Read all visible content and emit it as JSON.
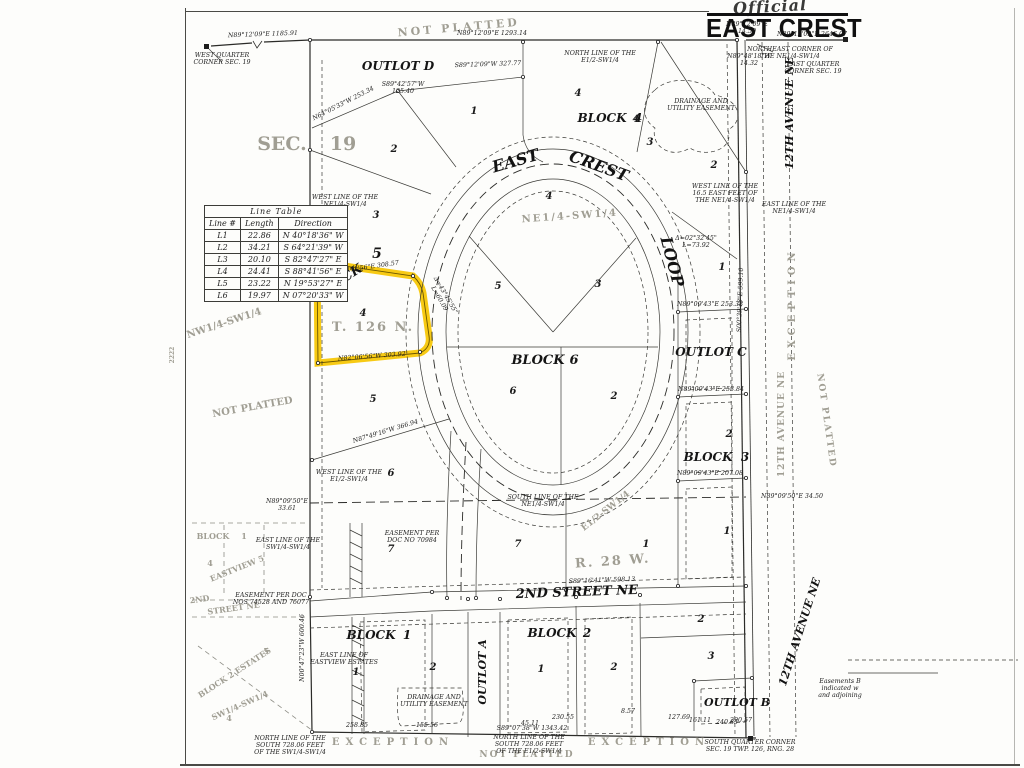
{
  "title": {
    "handwritten": "Official",
    "main": "EAST CREST"
  },
  "colors": {
    "highlight": "#f6c500",
    "ink": "#2b2b28",
    "watermark": "#a09e93",
    "paper": "#fdfdfb"
  },
  "line_table": {
    "title": "Line Table",
    "headers": [
      "Line #",
      "Length",
      "Direction"
    ],
    "rows": [
      [
        "L1",
        "22.86",
        "N 40°18'36\" W"
      ],
      [
        "L2",
        "34.21",
        "S 64°21'39\" W"
      ],
      [
        "L3",
        "20.10",
        "S 82°47'27\" E"
      ],
      [
        "L4",
        "24.41",
        "S 88°41'56\" E"
      ],
      [
        "L5",
        "23.22",
        "N 19°53'27\" E"
      ],
      [
        "L6",
        "19.97",
        "N 07°20'33\" W"
      ]
    ]
  },
  "map": {
    "labels": [
      {
        "n": "street-east",
        "c": "street",
        "t": "EAST",
        "x": 517,
        "y": 166,
        "s": 16,
        "r": -16
      },
      {
        "n": "street-crest",
        "c": "street",
        "t": "CREST",
        "x": 597,
        "y": 171,
        "s": 16,
        "r": 20
      },
      {
        "n": "street-loop",
        "c": "street",
        "t": "LOOP",
        "x": 667,
        "y": 263,
        "s": 16,
        "r": 75
      },
      {
        "n": "street-2nd-street-ne",
        "c": "street",
        "t": "2ND STREET NE",
        "x": 577,
        "y": 596,
        "s": 13,
        "r": -2
      },
      {
        "n": "street-12th-avenue-ne-top",
        "c": "street",
        "t": "12TH AVENUE NE",
        "x": 793,
        "y": 113,
        "s": 11,
        "r": -90
      },
      {
        "n": "street-12th-avenue-ne-bottom",
        "c": "street",
        "t": "12TH AVENUE NE",
        "x": 803,
        "y": 633,
        "s": 11,
        "r": -72
      },
      {
        "n": "outlot-d-label",
        "c": "block",
        "t": "OUTLOT D",
        "x": 398,
        "y": 70
      },
      {
        "n": "block-4-label",
        "c": "block",
        "t": "BLOCK",
        "x": 602,
        "y": 122
      },
      {
        "n": "block-4-number",
        "c": "block",
        "t": "4",
        "x": 638,
        "y": 122
      },
      {
        "n": "block-5-label",
        "c": "block",
        "t": "BLOCK",
        "x": 341,
        "y": 285,
        "r": -33,
        "s": 13
      },
      {
        "n": "block-5-number",
        "c": "block",
        "t": "5",
        "x": 377,
        "y": 258,
        "s": 14
      },
      {
        "n": "block-6-label",
        "c": "block",
        "t": "BLOCK",
        "x": 538,
        "y": 364,
        "s": 13
      },
      {
        "n": "block-6-number",
        "c": "block",
        "t": "6",
        "x": 574,
        "y": 364,
        "s": 13
      },
      {
        "n": "outlot-c-label",
        "c": "block",
        "t": "OUTLOT C",
        "x": 711,
        "y": 356
      },
      {
        "n": "block-3-label",
        "c": "block",
        "t": "BLOCK",
        "x": 708,
        "y": 461
      },
      {
        "n": "block-3-number",
        "c": "block",
        "t": "3",
        "x": 745,
        "y": 461
      },
      {
        "n": "block-1-label",
        "c": "block",
        "t": "BLOCK",
        "x": 371,
        "y": 639
      },
      {
        "n": "block-1-number",
        "c": "block",
        "t": "1",
        "x": 407,
        "y": 639
      },
      {
        "n": "block-2-label",
        "c": "block",
        "t": "BLOCK",
        "x": 552,
        "y": 637
      },
      {
        "n": "block-2-number",
        "c": "block",
        "t": "2",
        "x": 587,
        "y": 637
      },
      {
        "n": "outlot-a-label",
        "c": "block",
        "t": "OUTLOT A",
        "x": 486,
        "y": 672,
        "s": 11,
        "r": -90
      },
      {
        "n": "outlot-b-label",
        "c": "block",
        "t": "OUTLOT B",
        "x": 737,
        "y": 706,
        "s": 11
      },
      {
        "n": "lot-number",
        "c": "lot",
        "t": "2",
        "x": 394,
        "y": 152
      },
      {
        "n": "lot-number",
        "c": "lot",
        "t": "3",
        "x": 376,
        "y": 218
      },
      {
        "n": "lot-number",
        "c": "lot",
        "t": "4",
        "x": 363,
        "y": 316
      },
      {
        "n": "lot-number",
        "c": "lot",
        "t": "5",
        "x": 373,
        "y": 402
      },
      {
        "n": "lot-number",
        "c": "lot",
        "t": "6",
        "x": 391,
        "y": 476
      },
      {
        "n": "lot-number",
        "c": "lot",
        "t": "7",
        "x": 391,
        "y": 552
      },
      {
        "n": "lot-number",
        "c": "lot",
        "t": "1",
        "x": 474,
        "y": 114
      },
      {
        "n": "lot-number",
        "c": "lot",
        "t": "4",
        "x": 578,
        "y": 96
      },
      {
        "n": "lot-number",
        "c": "lot",
        "t": "4",
        "x": 636,
        "y": 122
      },
      {
        "n": "lot-number",
        "c": "lot",
        "t": "3",
        "x": 650,
        "y": 145
      },
      {
        "n": "lot-number",
        "c": "lot",
        "t": "2",
        "x": 714,
        "y": 168
      },
      {
        "n": "lot-number",
        "c": "lot",
        "t": "1",
        "x": 722,
        "y": 270
      },
      {
        "n": "lot-number",
        "c": "lot",
        "t": "2",
        "x": 729,
        "y": 437
      },
      {
        "n": "lot-number",
        "c": "lot",
        "t": "1",
        "x": 727,
        "y": 534
      },
      {
        "n": "lot-number",
        "c": "lot",
        "t": "4",
        "x": 549,
        "y": 199
      },
      {
        "n": "lot-number",
        "c": "lot",
        "t": "5",
        "x": 498,
        "y": 289
      },
      {
        "n": "lot-number",
        "c": "lot",
        "t": "3",
        "x": 598,
        "y": 287
      },
      {
        "n": "lot-number",
        "c": "lot",
        "t": "6",
        "x": 513,
        "y": 394
      },
      {
        "n": "lot-number",
        "c": "lot",
        "t": "2",
        "x": 614,
        "y": 399
      },
      {
        "n": "lot-number",
        "c": "lot",
        "t": "7",
        "x": 518,
        "y": 547
      },
      {
        "n": "lot-number",
        "c": "lot",
        "t": "1",
        "x": 646,
        "y": 547
      },
      {
        "n": "lot-number",
        "c": "lot",
        "t": "1",
        "x": 356,
        "y": 675
      },
      {
        "n": "lot-number",
        "c": "lot",
        "t": "2",
        "x": 433,
        "y": 670
      },
      {
        "n": "lot-number",
        "c": "lot",
        "t": "1",
        "x": 541,
        "y": 672
      },
      {
        "n": "lot-number",
        "c": "lot",
        "t": "2",
        "x": 614,
        "y": 670
      },
      {
        "n": "lot-number",
        "c": "lot",
        "t": "2",
        "x": 701,
        "y": 622
      },
      {
        "n": "lot-number",
        "c": "lot",
        "t": "3",
        "x": 711,
        "y": 659
      },
      {
        "n": "wm-not-platted-top",
        "c": "wm",
        "t": "NOT  PLATTED",
        "x": 459,
        "y": 31,
        "s": 11,
        "r": -5,
        "sp": 3
      },
      {
        "n": "wm-sec",
        "c": "wm",
        "t": "SEC.",
        "x": 282,
        "y": 150,
        "s": 19
      },
      {
        "n": "wm-19",
        "c": "wm",
        "t": "19",
        "x": 343,
        "y": 150,
        "s": 19
      },
      {
        "n": "wm-nw14-sw14",
        "c": "wm",
        "t": "NW1/4-SW1/4",
        "x": 225,
        "y": 326,
        "s": 10,
        "r": -18
      },
      {
        "n": "wm-not-platted-left",
        "c": "wm",
        "t": "NOT  PLATTED",
        "x": 253,
        "y": 410,
        "s": 10,
        "r": -10
      },
      {
        "n": "wm-ne14-sw14",
        "c": "wm",
        "t": "NE1/4-SW1/4",
        "x": 570,
        "y": 219,
        "s": 10,
        "r": -4,
        "sp": 2
      },
      {
        "n": "wm-t126n",
        "c": "wm",
        "t": "T. 126 N.",
        "x": 373,
        "y": 331,
        "s": 13,
        "sp": 2
      },
      {
        "n": "wm-r28w",
        "c": "wm",
        "t": "R. 28 W.",
        "x": 613,
        "y": 565,
        "s": 13,
        "r": -4,
        "sp": 2
      },
      {
        "n": "wm-e12-sw14",
        "c": "wm",
        "t": "E1/2-SW1/4",
        "x": 607,
        "y": 513,
        "s": 9,
        "r": -38
      },
      {
        "n": "wm-exception-right",
        "c": "wm",
        "t": "EXCEPTION",
        "x": 795,
        "y": 304,
        "s": 10,
        "r": -90,
        "sp": 5
      },
      {
        "n": "wm-12th-avenue-ne-gray",
        "c": "wm",
        "t": "12TH AVENUE NE",
        "x": 784,
        "y": 424,
        "s": 9,
        "r": -90,
        "sp": 1
      },
      {
        "n": "wm-not-platted-right",
        "c": "wm",
        "t": "NOT  PLATTED",
        "x": 824,
        "y": 421,
        "s": 9,
        "r": 82,
        "sp": 2
      },
      {
        "n": "wm-exception-bottom-left",
        "c": "wm",
        "t": "EXCEPTION",
        "x": 393,
        "y": 745,
        "s": 10,
        "sp": 6
      },
      {
        "n": "wm-exception-bottom-right",
        "c": "wm",
        "t": "EXCEPTION",
        "x": 649,
        "y": 745,
        "s": 10,
        "sp": 6
      },
      {
        "n": "wm-not-platted-bottom",
        "c": "wm",
        "t": "NOT  PLATTED",
        "x": 527,
        "y": 757,
        "s": 9,
        "sp": 2
      },
      {
        "n": "wm-block-1",
        "c": "wm",
        "t": "BLOCK",
        "x": 213,
        "y": 539,
        "s": 8
      },
      {
        "n": "wm-block-1-number",
        "c": "wm",
        "t": "1",
        "x": 244,
        "y": 539,
        "s": 8
      },
      {
        "n": "wm-eastview-4",
        "c": "wm",
        "t": "4",
        "x": 210,
        "y": 566,
        "s": 8
      },
      {
        "n": "wm-eastview",
        "c": "wm",
        "t": "EASTVIEW  5",
        "x": 238,
        "y": 571,
        "s": 8,
        "r": -22
      },
      {
        "n": "wm-2nd",
        "c": "wm",
        "t": "2ND",
        "x": 200,
        "y": 602,
        "s": 8,
        "r": -8
      },
      {
        "n": "wm-street-ne",
        "c": "wm",
        "t": "STREET  NE",
        "x": 234,
        "y": 611,
        "s": 8,
        "r": -8
      },
      {
        "n": "wm-block-2-estates",
        "c": "wm",
        "t": "BLOCK 2 ESTATES",
        "x": 236,
        "y": 675,
        "s": 8,
        "r": -33
      },
      {
        "n": "wm-estates-5",
        "c": "wm",
        "t": "5",
        "x": 266,
        "y": 654,
        "s": 8
      },
      {
        "n": "wm-sw14-sw14",
        "c": "wm",
        "t": "SW1/4-SW1/4",
        "x": 241,
        "y": 708,
        "s": 8,
        "r": -24
      },
      {
        "n": "wm-sw14-4",
        "c": "wm",
        "t": "4",
        "x": 229,
        "y": 721,
        "s": 8
      },
      {
        "n": "wm-2222",
        "c": "wm",
        "t": "2222",
        "x": 174,
        "y": 355,
        "s": 6,
        "r": -90
      },
      {
        "n": "note-west-quarter-corner",
        "c": "note",
        "t": "WEST QUARTER\nCORNER SEC. 19",
        "x": 222,
        "y": 57
      },
      {
        "n": "note-north-line",
        "c": "note",
        "t": "NORTH LINE OF THE\nE1/2-SW1/4",
        "x": 600,
        "y": 55
      },
      {
        "n": "note-northeast-corner",
        "c": "note",
        "t": "NORTHEAST CORNER OF\nTHE NE1/4-SW1/4",
        "x": 790,
        "y": 51
      },
      {
        "n": "note-east-quarter-corner",
        "c": "note",
        "t": "EAST QUARTER\nCORNER SEC. 19",
        "x": 813,
        "y": 66
      },
      {
        "n": "note-west-line-165",
        "c": "note",
        "t": "WEST LINE OF THE\n16.5 EAST FEET OF\nTHE NE1/4-SW1/4",
        "x": 725,
        "y": 188
      },
      {
        "n": "note-east-line-ne14",
        "c": "note",
        "t": "EAST LINE OF THE\nNE1/4-SW1/4",
        "x": 794,
        "y": 206
      },
      {
        "n": "note-west-line-ne14",
        "c": "note",
        "t": "WEST LINE OF THE\nNE1/4-SW1/4",
        "x": 345,
        "y": 199
      },
      {
        "n": "note-west-line-e12",
        "c": "note",
        "t": "WEST LINE OF THE\nE1/2-SW1/4",
        "x": 349,
        "y": 474
      },
      {
        "n": "note-south-line-ne14",
        "c": "note",
        "t": "SOUTH LINE OF THE\nNE1/4-SW1/4",
        "x": 543,
        "y": 499
      },
      {
        "n": "note-east-line-sw14",
        "c": "note",
        "t": "EAST LINE OF THE\nSW1/4-SW1/4",
        "x": 288,
        "y": 542
      },
      {
        "n": "note-easement-70984",
        "c": "note",
        "t": "EASEMENT PER\nDOC NO 70984",
        "x": 412,
        "y": 535
      },
      {
        "n": "note-easement-74528",
        "c": "note",
        "t": "EASEMENT PER DOC\nNOS 74528 AND 76077",
        "x": 271,
        "y": 597
      },
      {
        "n": "note-east-line-eastview",
        "c": "note",
        "t": "EAST LINE OF\nEASTVIEW ESTATES",
        "x": 344,
        "y": 657
      },
      {
        "n": "note-drainage-top",
        "c": "note",
        "t": "DRAINAGE AND\nUTILITY EASEMENT",
        "x": 701,
        "y": 103
      },
      {
        "n": "note-drainage-bottom",
        "c": "note",
        "t": "DRAINAGE AND\nUTILITY EASEMENT",
        "x": 434,
        "y": 699
      },
      {
        "n": "note-north-line-south-72806-sw",
        "c": "note",
        "t": "NORTH LINE OF THE\nSOUTH 728.06 FEET\nOF THE SW1/4-SW1/4",
        "x": 290,
        "y": 740
      },
      {
        "n": "note-north-line-south-72806-e12",
        "c": "note",
        "t": "NORTH LINE OF THE\nSOUTH 728.06 FEET\nOF THE E1/2-SW1/4",
        "x": 529,
        "y": 739
      },
      {
        "n": "note-south-quarter-corner",
        "c": "note",
        "t": "SOUTH QUARTER CORNER\nSEC. 19 TWP. 126, RNG. 28",
        "x": 750,
        "y": 744
      },
      {
        "n": "note-easements-edge",
        "c": "note",
        "t": "Easements B\nindicated w\nand adjoining",
        "x": 840,
        "y": 683
      },
      {
        "n": "bearing",
        "c": "bearing",
        "t": "N89°12'09\"E   1185.91",
        "x": 263,
        "y": 36,
        "r": -2
      },
      {
        "n": "bearing",
        "c": "bearing",
        "t": "N89°12'09\"E   1293.14",
        "x": 492,
        "y": 35
      },
      {
        "n": "bearing",
        "c": "bearing",
        "t": "N89°12'09\"E\n14.50",
        "x": 747,
        "y": 26
      },
      {
        "n": "bearing",
        "c": "bearing",
        "t": "N89°12'09\"E   2646.07",
        "x": 812,
        "y": 36
      },
      {
        "n": "bearing",
        "c": "bearing",
        "t": "N89°48'18\"W\n14.32",
        "x": 749,
        "y": 58
      },
      {
        "n": "bearing",
        "c": "bearing",
        "t": "S89°12'09\"W 327.77",
        "x": 488,
        "y": 66,
        "r": -2
      },
      {
        "n": "bearing",
        "c": "bearing",
        "t": "S89°42'57\"W\n125.40",
        "x": 403,
        "y": 86
      },
      {
        "n": "bearing",
        "c": "bearing",
        "t": "N64°05'33\"W 253.34",
        "x": 344,
        "y": 105,
        "r": -27
      },
      {
        "n": "bearing",
        "c": "bearing",
        "t": "S88°41'56\"E 308.57",
        "x": 367,
        "y": 269,
        "r": -8
      },
      {
        "n": "bearing",
        "c": "bearing",
        "t": "N82°06'56\"W 303.92",
        "x": 372,
        "y": 358,
        "r": -4
      },
      {
        "n": "bearing",
        "c": "bearing",
        "t": "N87°49'16\"W 366.94",
        "x": 386,
        "y": 433,
        "r": -17
      },
      {
        "n": "bearing",
        "c": "bearing",
        "t": "N89°09'50\"E\n33.61",
        "x": 287,
        "y": 503
      },
      {
        "n": "bearing",
        "c": "bearing",
        "t": "N89°09'50\"E 34.50",
        "x": 792,
        "y": 498
      },
      {
        "n": "bearing",
        "c": "bearing",
        "t": "N89°09'43\"E 253.38",
        "x": 710,
        "y": 306
      },
      {
        "n": "bearing",
        "c": "bearing",
        "t": "N89°09'43\"E 253.84",
        "x": 711,
        "y": 391
      },
      {
        "n": "bearing",
        "c": "bearing",
        "t": "N89°09'43\"E 207.08",
        "x": 710,
        "y": 475
      },
      {
        "n": "bearing",
        "c": "bearing",
        "t": "S89°16'41\"W 598.13",
        "x": 602,
        "y": 582,
        "r": -2
      },
      {
        "n": "bearing",
        "c": "bearing",
        "t": "S89°07'38\"W 1343.42",
        "x": 532,
        "y": 730
      },
      {
        "n": "bearing",
        "c": "bearing",
        "t": "Δ=02°32'45\"\nL=73.92",
        "x": 696,
        "y": 240
      },
      {
        "n": "bearing",
        "c": "bearing",
        "t": "Δ=43°45'55\"\nL=60.09",
        "x": 444,
        "y": 296,
        "r": 60
      },
      {
        "n": "bearing",
        "c": "bearing",
        "t": "N00°47'23\"W 600.46",
        "x": 304,
        "y": 648,
        "r": -90
      },
      {
        "n": "bearing",
        "c": "bearing",
        "t": "S00°39'18\"E 599.10",
        "x": 742,
        "y": 300,
        "r": -88
      },
      {
        "n": "bearing",
        "c": "bearing",
        "t": "258.85",
        "x": 357,
        "y": 727
      },
      {
        "n": "bearing",
        "c": "bearing",
        "t": "155.56",
        "x": 427,
        "y": 727
      },
      {
        "n": "bearing",
        "c": "bearing",
        "t": "45.11",
        "x": 530,
        "y": 725
      },
      {
        "n": "bearing",
        "c": "bearing",
        "t": "230.55",
        "x": 563,
        "y": 719
      },
      {
        "n": "bearing",
        "c": "bearing",
        "t": "8.57",
        "x": 628,
        "y": 713
      },
      {
        "n": "bearing",
        "c": "bearing",
        "t": "161.11",
        "x": 700,
        "y": 722
      },
      {
        "n": "bearing",
        "c": "bearing",
        "t": "240.85",
        "x": 727,
        "y": 724
      },
      {
        "n": "bearing",
        "c": "bearing",
        "t": "127.69",
        "x": 679,
        "y": 719
      },
      {
        "n": "bearing",
        "c": "bearing",
        "t": "290.57",
        "x": 741,
        "y": 722
      }
    ]
  }
}
